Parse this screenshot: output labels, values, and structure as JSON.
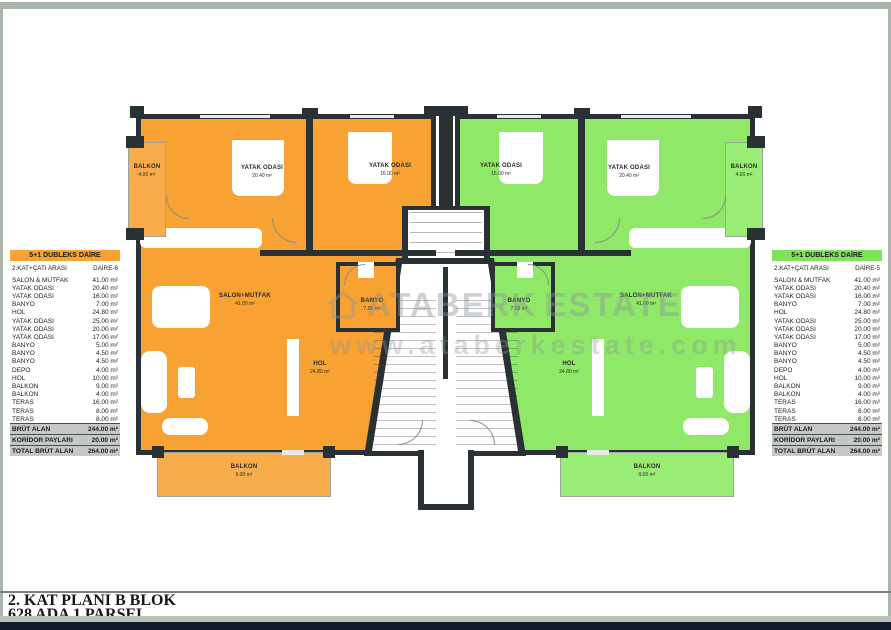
{
  "title_block": {
    "line1": "2. KAT PLANI B BLOK",
    "line2": "628 ADA 1 PARSEL"
  },
  "watermark": {
    "brand_left": "ATABERK",
    "brand_right": "ESTATE",
    "url": "www.ataberkestate.com",
    "house_icon": "house-outline-icon"
  },
  "colors": {
    "unit_left_fill": "#F7A233",
    "unit_right_fill": "#8FE868",
    "wall": "#2A3134",
    "table_header_left": "#F7A233",
    "table_header_right": "#7FE35A",
    "summary_row_bg": "#C4C9C6"
  },
  "table_left": {
    "header": "5+1 DUBLEKS DAİRE",
    "floor_label": "2.KAT+ÇATI ARASI",
    "unit_label": "DAİRE-6",
    "rows": [
      {
        "label": "SALON & MUTFAK",
        "value": "41.00 m²"
      },
      {
        "label": "YATAK ODASI",
        "value": "20.40 m²"
      },
      {
        "label": "YATAK ODASI",
        "value": "16.00 m²"
      },
      {
        "label": "BANYO",
        "value": "7.00 m²"
      },
      {
        "label": "HOL",
        "value": "24.80 m²"
      },
      {
        "label": "YATAK ODASI",
        "value": "25.00 m²"
      },
      {
        "label": "YATAK ODASI",
        "value": "20.00 m²"
      },
      {
        "label": "YATAK ODASI",
        "value": "17.00 m²"
      },
      {
        "label": "BANYO",
        "value": "5.00 m²"
      },
      {
        "label": "BANYO",
        "value": "4.50 m²"
      },
      {
        "label": "BANYO",
        "value": "4.50 m²"
      },
      {
        "label": "DEPO",
        "value": "4.00 m²"
      },
      {
        "label": "HOL",
        "value": "10.00 m²"
      },
      {
        "label": "BALKON",
        "value": "9.00 m²"
      },
      {
        "label": "BALKON",
        "value": "4.00 m²"
      },
      {
        "label": "TERAS",
        "value": "16.00 m²"
      },
      {
        "label": "TERAS",
        "value": "8.00 m²"
      },
      {
        "label": "TERAS",
        "value": "8.00 m²"
      }
    ],
    "summary": [
      {
        "label": "BRÜT ALAN",
        "value": "244.00 m²"
      },
      {
        "label": "KORİDOR PAYLARI",
        "value": "20.00 m²"
      },
      {
        "label": "TOTAL BRÜT ALAN",
        "value": "264.00 m²"
      }
    ]
  },
  "table_right": {
    "header": "5+1 DUBLEKS DAİRE",
    "floor_label": "2.KAT+ÇATI ARASI",
    "unit_label": "DAİRE-5",
    "rows": [
      {
        "label": "SALON & MUTFAK",
        "value": "41.00 m²"
      },
      {
        "label": "YATAK ODASI",
        "value": "20.40 m²"
      },
      {
        "label": "YATAK ODASI",
        "value": "16.00 m²"
      },
      {
        "label": "BANYO",
        "value": "7.00 m²"
      },
      {
        "label": "HOL",
        "value": "24.80 m²"
      },
      {
        "label": "YATAK ODASI",
        "value": "25.00 m²"
      },
      {
        "label": "YATAK ODASI",
        "value": "20.00 m²"
      },
      {
        "label": "YATAK ODASI",
        "value": "17.00 m²"
      },
      {
        "label": "BANYO",
        "value": "5.00 m²"
      },
      {
        "label": "BANYO",
        "value": "4.50 m²"
      },
      {
        "label": "BANYO",
        "value": "4.50 m²"
      },
      {
        "label": "DEPO",
        "value": "4.00 m²"
      },
      {
        "label": "HOL",
        "value": "10.00 m²"
      },
      {
        "label": "BALKON",
        "value": "9.00 m²"
      },
      {
        "label": "BALKON",
        "value": "4.00 m²"
      },
      {
        "label": "TERAS",
        "value": "16.00 m²"
      },
      {
        "label": "TERAS",
        "value": "8.00 m²"
      },
      {
        "label": "TERAS",
        "value": "8.00 m²"
      }
    ],
    "summary": [
      {
        "label": "BRÜT ALAN",
        "value": "244.00 m²"
      },
      {
        "label": "KORİDOR PAYLARI",
        "value": "20.00 m²"
      },
      {
        "label": "TOTAL BRÜT ALAN",
        "value": "264.00 m²"
      }
    ]
  },
  "plan": {
    "left": {
      "rooms": [
        {
          "name": "BALKON",
          "area": "4.00 m²"
        },
        {
          "name": "YATAK ODASI",
          "area": "20.40 m²"
        },
        {
          "name": "YATAK ODASI",
          "area": "16.00 m²"
        },
        {
          "name": "SALON+MUTFAK",
          "area": "41.00 m²"
        },
        {
          "name": "BANYO",
          "area": "7.00 m²"
        },
        {
          "name": "HOL",
          "area": "24.80 m²"
        },
        {
          "name": "BALKON",
          "area": "9.00 m²"
        }
      ]
    },
    "right": {
      "rooms": [
        {
          "name": "YATAK ODASI",
          "area": "16.00 m²"
        },
        {
          "name": "YATAK ODASI",
          "area": "20.40 m²"
        },
        {
          "name": "BALKON",
          "area": "4.00 m²"
        },
        {
          "name": "BANYO",
          "area": "7.00 m²"
        },
        {
          "name": "SALON+MUTFAK",
          "area": "41.00 m²"
        },
        {
          "name": "HOL",
          "area": "24.80 m²"
        },
        {
          "name": "BALKON",
          "area": "9.00 m²"
        }
      ]
    }
  }
}
